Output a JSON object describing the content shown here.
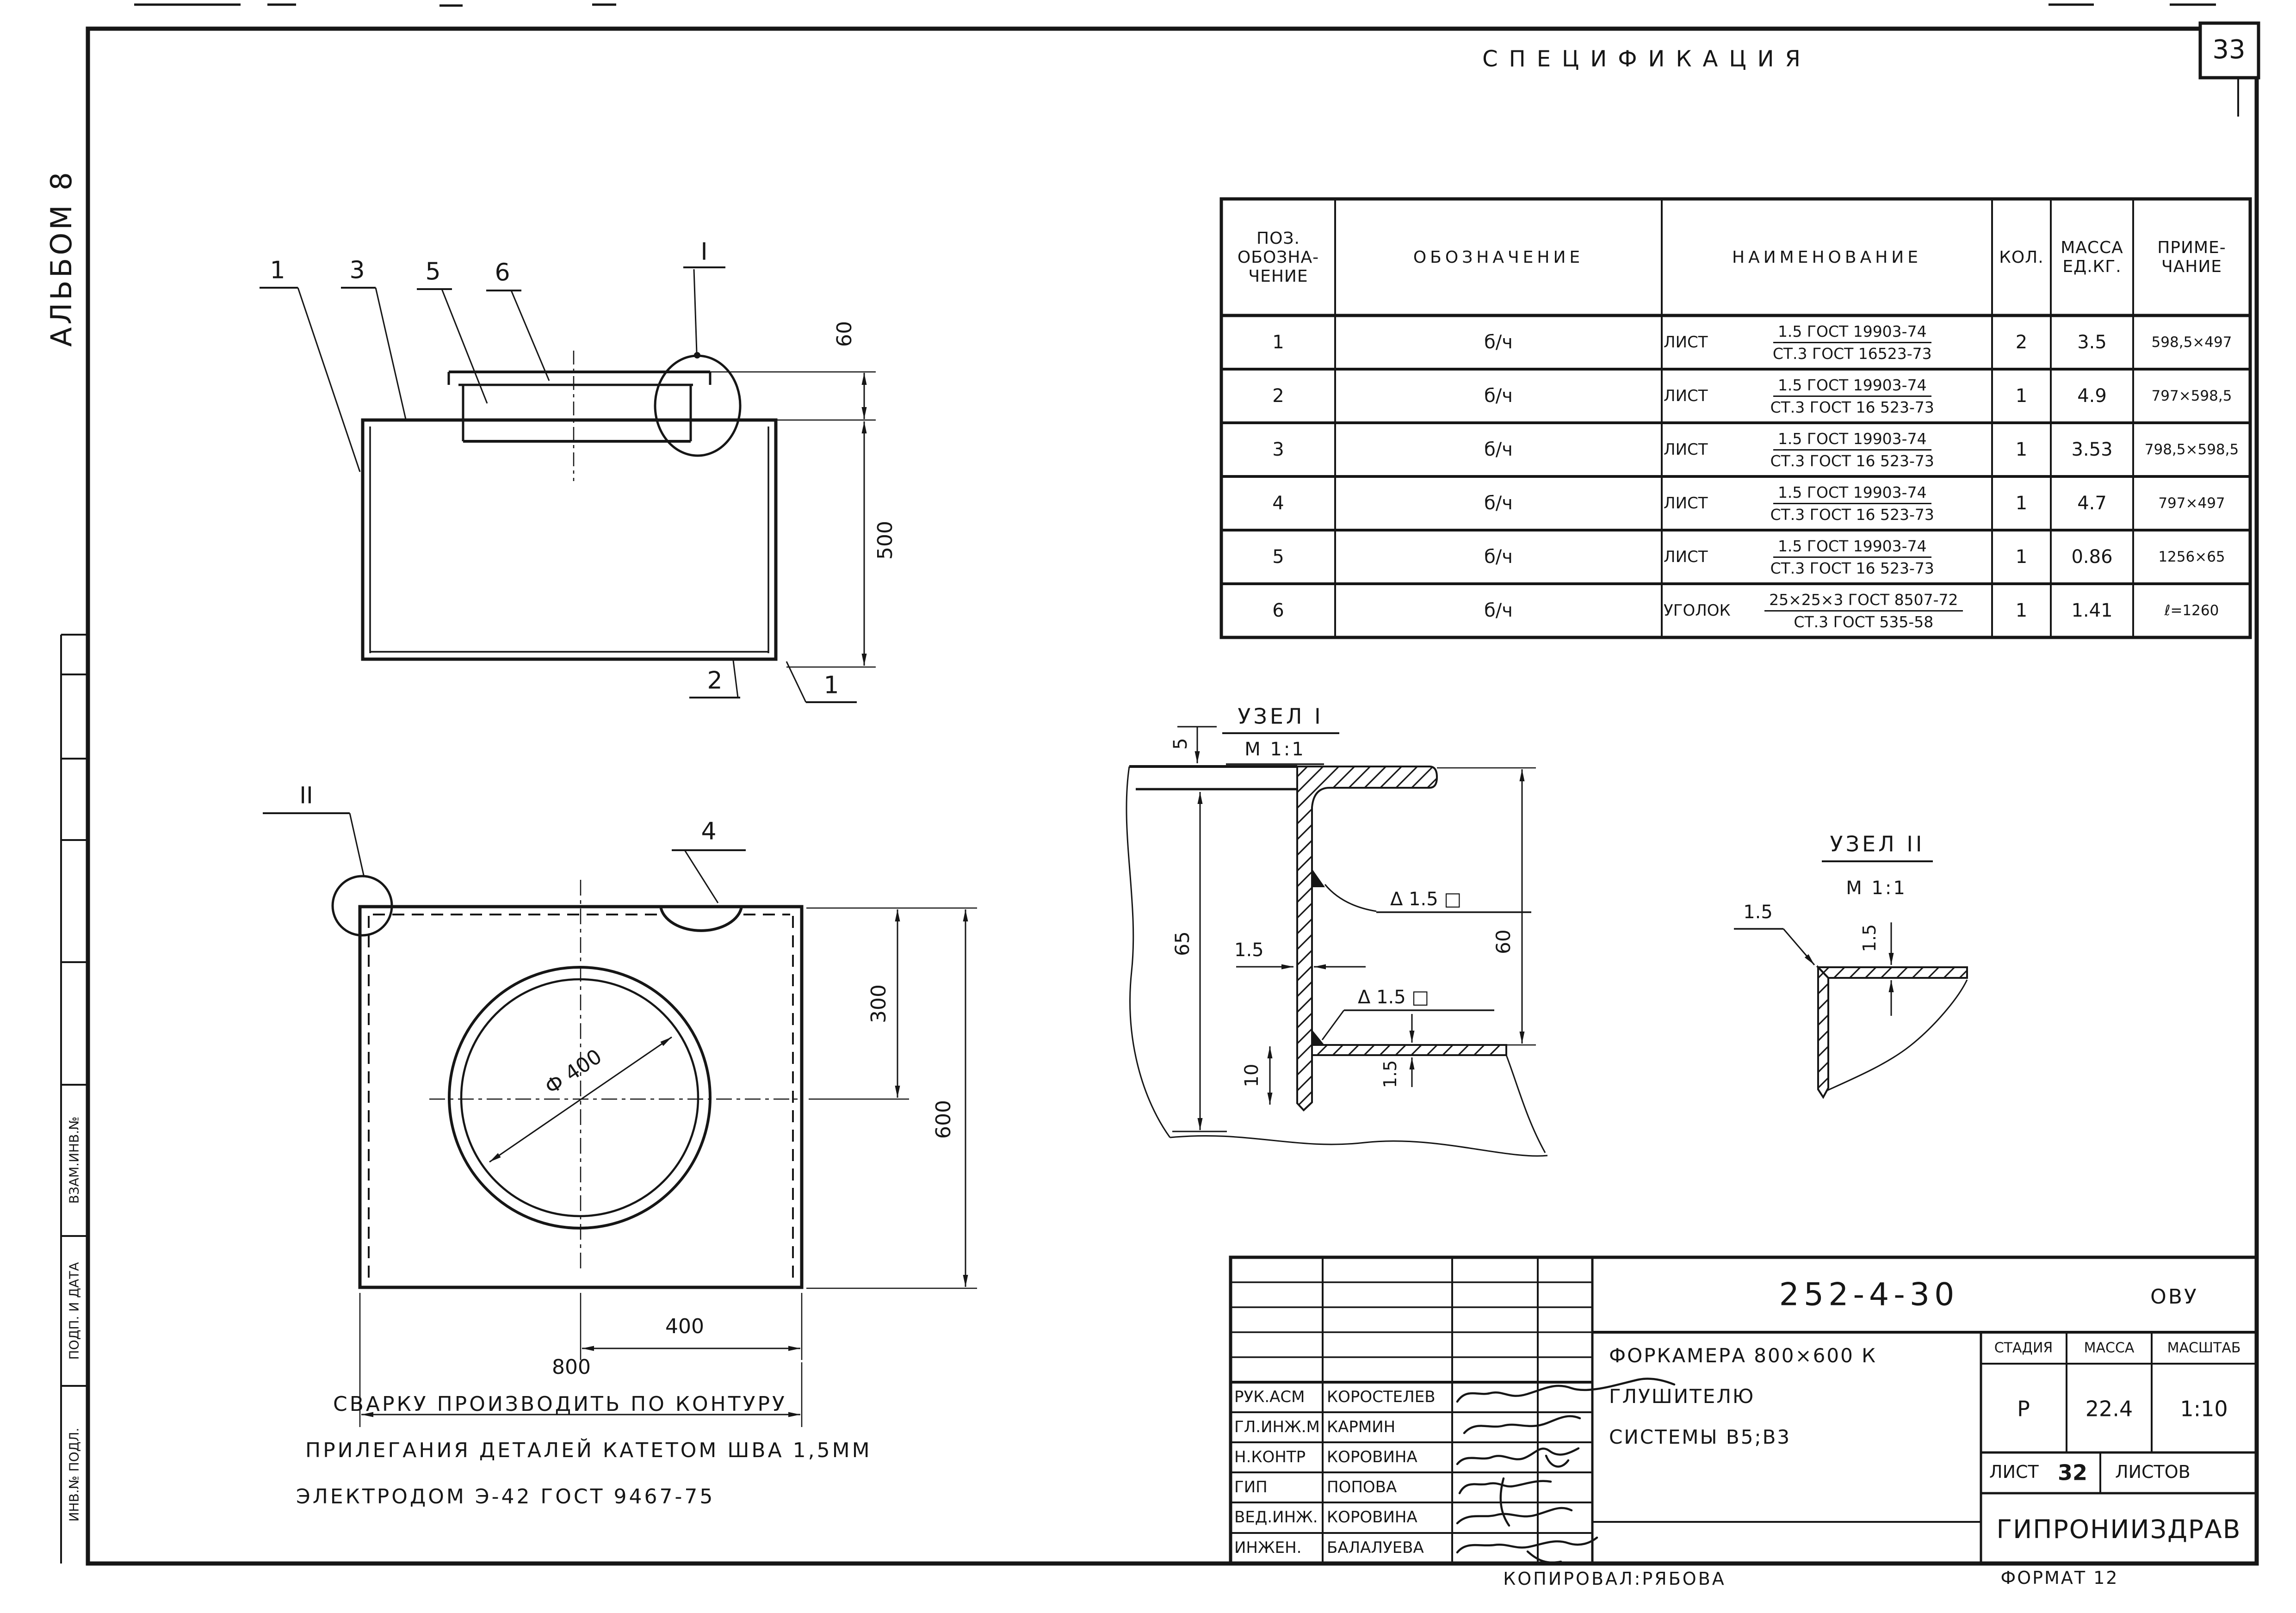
{
  "page": {
    "number": "33",
    "album": "АЛЬБОМ 8",
    "copied": "КОПИРОВАЛ:РЯБОВА",
    "format": "ФОРМАТ 12",
    "margin": {
      "vzam": "ВЗАМ.ИНВ.№",
      "podp": "ПОДП. И ДАТА",
      "inv": "ИНВ.№ ПОДЛ."
    }
  },
  "spec": {
    "title": "СПЕЦИФИКАЦИЯ",
    "headers": {
      "pos": "ПОЗ.\nОБОЗНА-\nЧЕНИЕ",
      "designation": "ОБОЗНАЧЕНИЕ",
      "name": "НАИМЕНОВАНИЕ",
      "qty": "КОЛ.",
      "mass": "МАССА\nЕД.КГ.",
      "note": "ПРИМЕ-\nЧАНИЕ"
    },
    "rows": [
      {
        "pos": "1",
        "designation": "б/ч",
        "prefix": "ЛИСТ",
        "top": "1.5 ГОСТ 19903-74",
        "bottom": "СТ.3 ГОСТ 16523-73",
        "qty": "2",
        "mass": "3.5",
        "note": "598,5×497"
      },
      {
        "pos": "2",
        "designation": "б/ч",
        "prefix": "ЛИСТ",
        "top": "1.5 ГОСТ 19903-74",
        "bottom": "СТ.3 ГОСТ 16 523-73",
        "qty": "1",
        "mass": "4.9",
        "note": "797×598,5"
      },
      {
        "pos": "3",
        "designation": "б/ч",
        "prefix": "ЛИСТ",
        "top": "1.5 ГОСТ 19903-74",
        "bottom": "СТ.3 ГОСТ 16 523-73",
        "qty": "1",
        "mass": "3.53",
        "note": "798,5×598,5"
      },
      {
        "pos": "4",
        "designation": "б/ч",
        "prefix": "ЛИСТ",
        "top": "1.5 ГОСТ 19903-74",
        "bottom": "СТ.3 ГОСТ 16 523-73",
        "qty": "1",
        "mass": "4.7",
        "note": "797×497"
      },
      {
        "pos": "5",
        "designation": "б/ч",
        "prefix": "ЛИСТ",
        "top": "1.5 ГОСТ 19903-74",
        "bottom": "СТ.3 ГОСТ 16 523-73",
        "qty": "1",
        "mass": "0.86",
        "note": "1256×65"
      },
      {
        "pos": "6",
        "designation": "б/ч",
        "prefix": "УГОЛОК",
        "top": "25×25×3 ГОСТ 8507-72",
        "bottom": "СТ.3 ГОСТ 535-58",
        "qty": "1",
        "mass": "1.41",
        "note": "ℓ=1260"
      }
    ]
  },
  "view1": {
    "callout_1_top": "1",
    "callout_3": "3",
    "callout_5": "5",
    "callout_6": "6",
    "callout_2": "2",
    "callout_1_bottom": "1",
    "detail_ref": "I",
    "dim_60": "60",
    "dim_500": "500"
  },
  "view2": {
    "callout_4": "4",
    "detail_ref": "II",
    "dim_300": "300",
    "dim_600": "600",
    "dim_400": "400",
    "dim_800": "800",
    "dim_dia": "Ф 400"
  },
  "node1": {
    "title": "УЗЕЛ I",
    "scale": "М 1:1",
    "weld_top": "Δ 1.5 □",
    "weld_bottom": "Δ 1.5 □",
    "dim_5": "5",
    "dim_65": "65",
    "dim_15_wall": "1.5",
    "dim_10": "10",
    "dim_15_sheet": "1.5",
    "dim_60": "60"
  },
  "node2": {
    "title": "УЗЕЛ II",
    "scale": "М 1:1",
    "weld": "1.5",
    "dim_15": "1.5"
  },
  "note": {
    "line1": "СВАРКУ ПРОИЗВОДИТЬ ПО КОНТУРУ",
    "line2": "ПРИЛЕГАНИЯ ДЕТАЛЕЙ КАТЕТОМ ШВА 1,5ММ",
    "line3": "ЭЛЕКТРОДОМ Э-42 ГОСТ 9467-75"
  },
  "stamp": {
    "doc_number": "252-4-30",
    "code": "ОВУ",
    "title1": "ФОРКАМЕРА 800×600 К",
    "title2": "ГЛУШИТЕЛЮ",
    "title3": "СИСТЕМЫ В5;В3",
    "stage_h": "СТАДИЯ",
    "mass_h": "МАССА",
    "scale_h": "МАСШТАБ",
    "stage": "Р",
    "mass": "22.4",
    "scale": "1:10",
    "sheet_h": "ЛИСТ",
    "sheet_no": "32",
    "sheets_h": "ЛИСТОВ",
    "org": "ГИПРОНИИЗДРАВ",
    "staff": [
      {
        "role": "РУК.АСМ",
        "name": "КОРОСТЕЛЕВ"
      },
      {
        "role": "ГЛ.ИНЖ.М",
        "name": "КАРМИН"
      },
      {
        "role": "Н.КОНТР",
        "name": "КОРОВИНА"
      },
      {
        "role": "ГИП",
        "name": "ПОПОВА"
      },
      {
        "role": "ВЕД.ИНЖ.",
        "name": "КОРОВИНА"
      },
      {
        "role": "ИНЖЕН.",
        "name": "БАЛАЛУЕВА"
      }
    ]
  }
}
